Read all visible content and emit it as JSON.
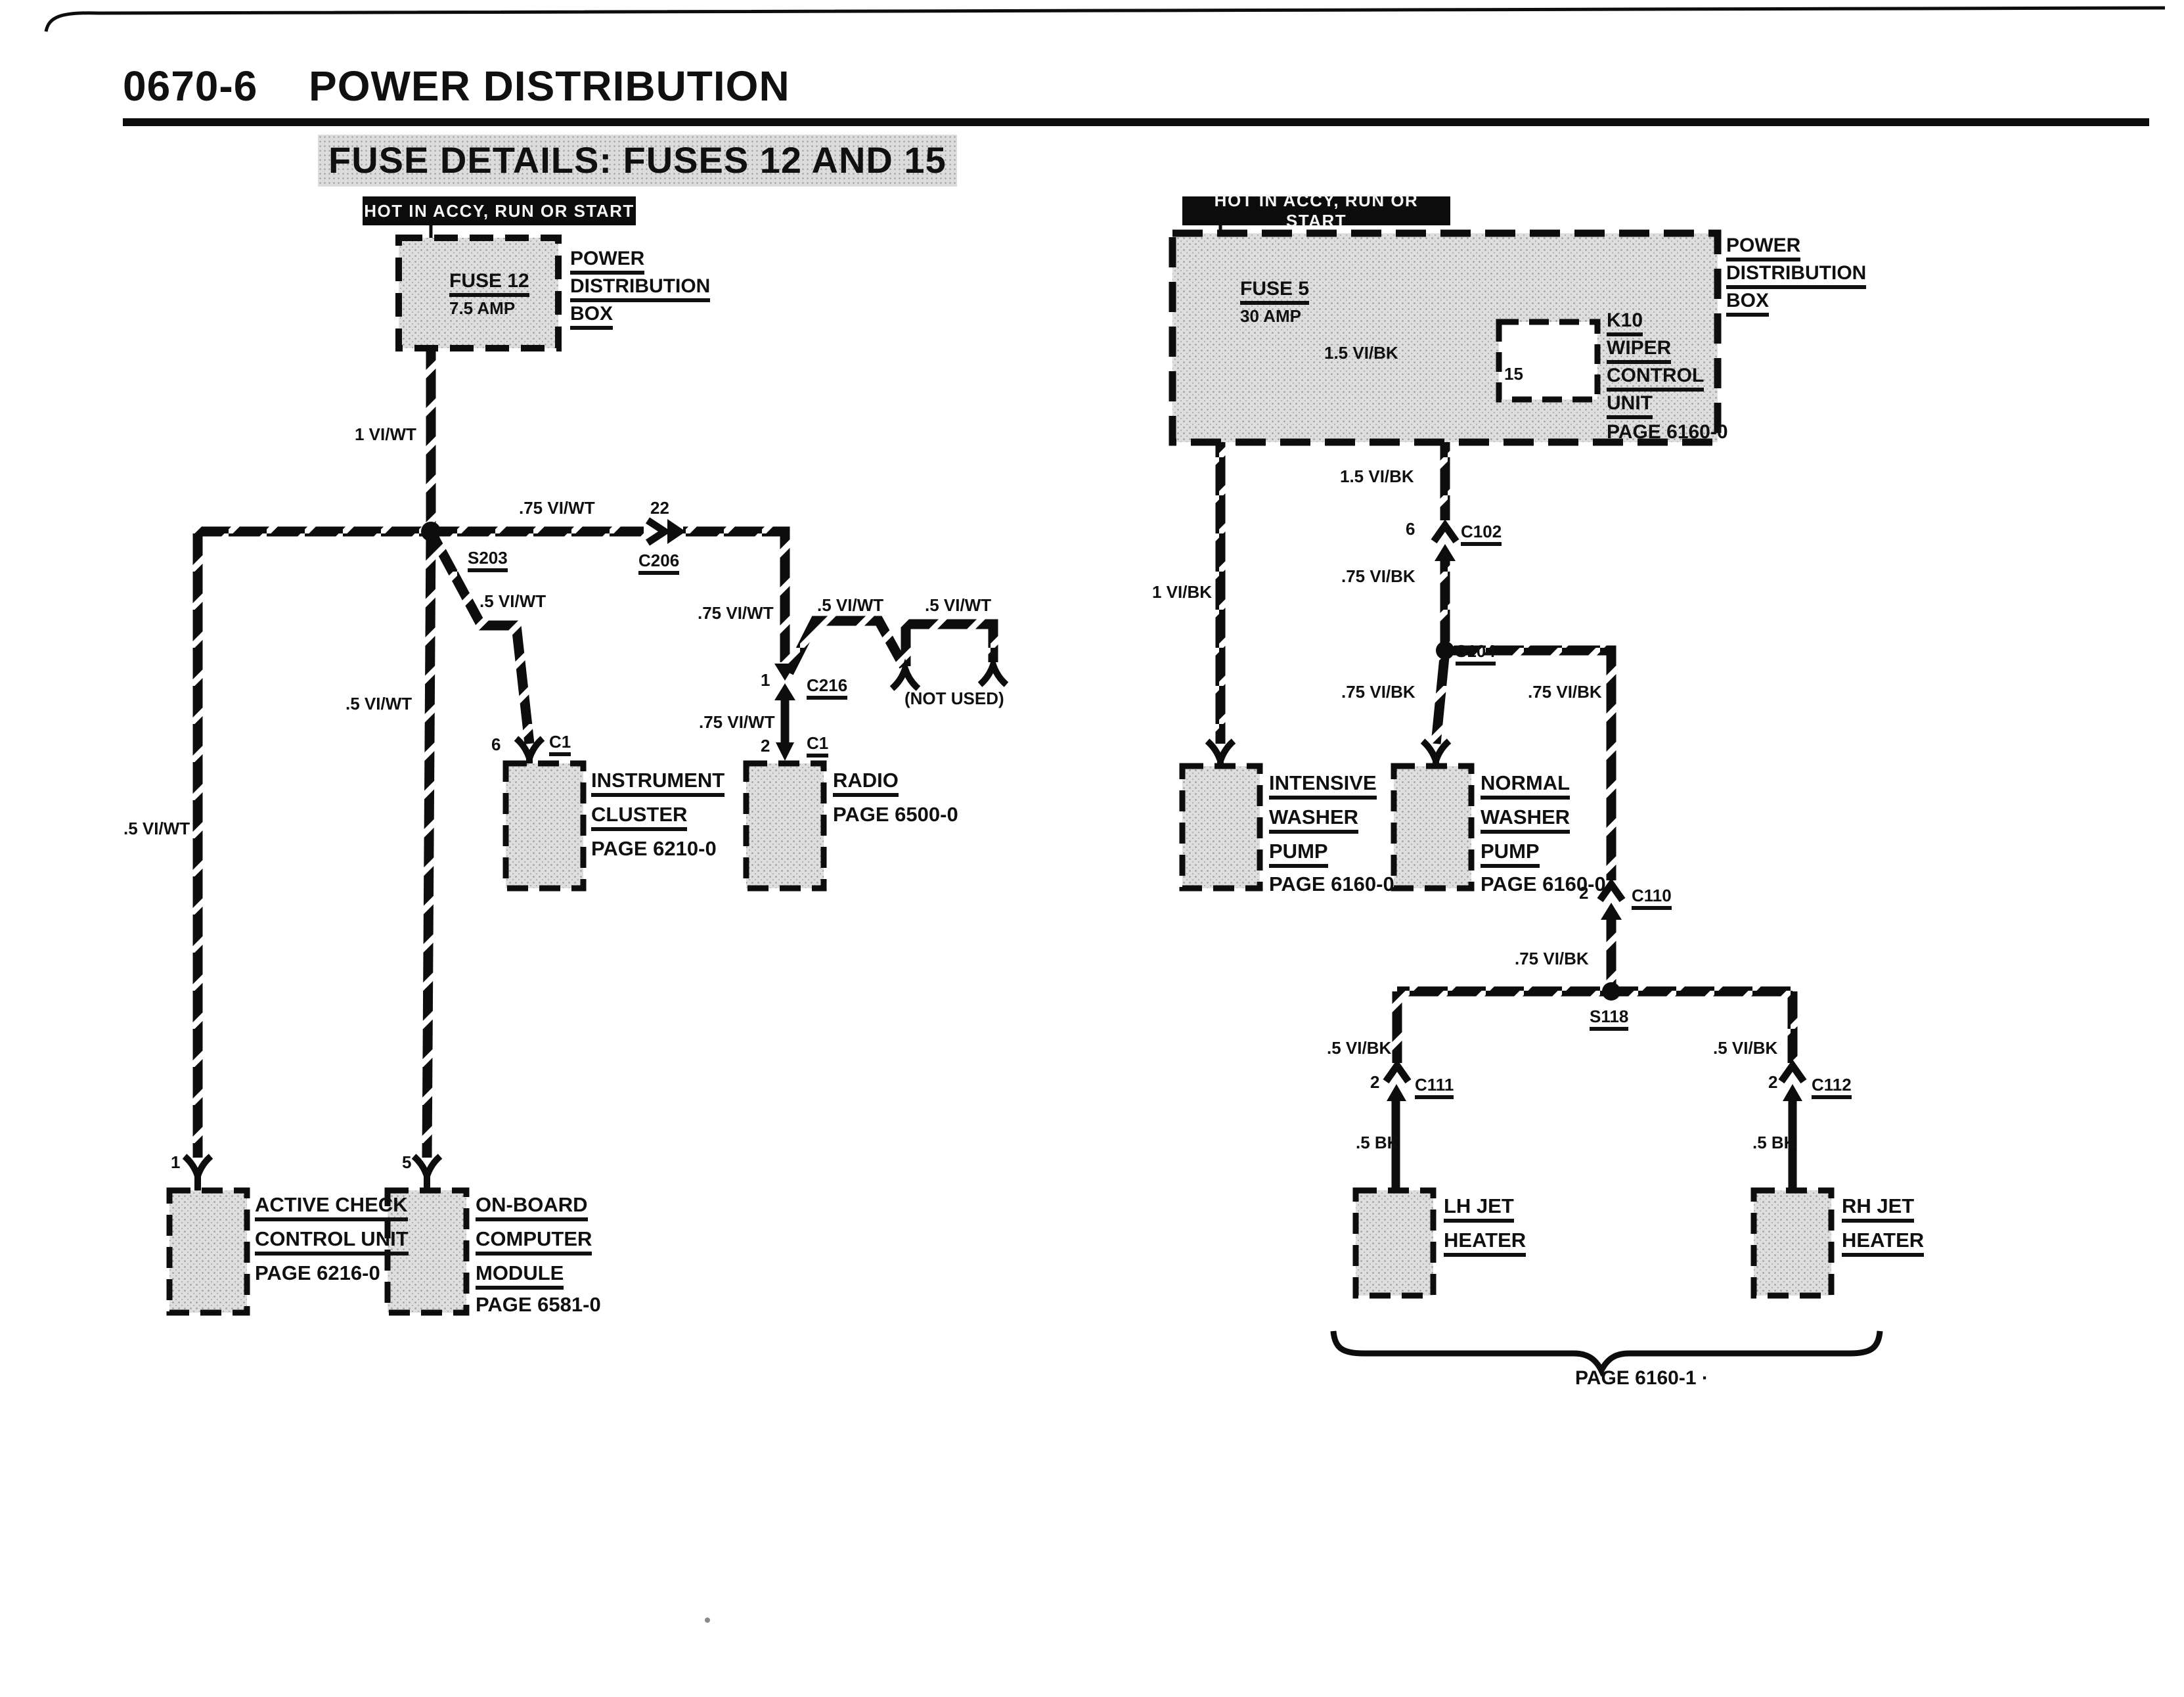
{
  "colors": {
    "ink": "#101010",
    "paper": "#ffffff",
    "shade": "#dcdcdc"
  },
  "page": {
    "doc_number": "0670-6",
    "title": "POWER DISTRIBUTION",
    "subtitle": "FUSE DETAILS: FUSES 12 AND 15"
  },
  "left": {
    "banner": "HOT IN ACCY, RUN OR START",
    "fuse_name": "FUSE 12",
    "fuse_rating": "7.5 AMP",
    "power_box": {
      "l1": "POWER",
      "l2": "DISTRIBUTION",
      "l3": "BOX"
    },
    "w_main": "1 VI/WT",
    "s203": "S203",
    "w_branch": ".75 VI/WT",
    "pin22": "22",
    "c206": "C206",
    "w_instr": ".5 VI/WT",
    "pin6": "6",
    "c1a": "C1",
    "instrument": {
      "l1": "INSTRUMENT",
      "l2": "CLUSTER",
      "page": "PAGE 6210-0"
    },
    "w_c216": ".75 VI/WT",
    "pin1_c216": "1",
    "c216": "C216",
    "w_nu1": ".5 VI/WT",
    "w_nu2": ".5 VI/WT",
    "not_used": "(NOT USED)",
    "w_radio": ".75 VI/WT",
    "pin2": "2",
    "c1b": "C1",
    "radio": {
      "l1": "RADIO",
      "page": "PAGE 6500-0"
    },
    "w_obc": ".5 VI/WT",
    "w_accu": ".5 VI/WT",
    "pin1_accu": "1",
    "active": {
      "l1": "ACTIVE CHECK",
      "l2": "CONTROL UNIT",
      "page": "PAGE 6216-0"
    },
    "pin5": "5",
    "obc": {
      "l1": "ON-BOARD",
      "l2": "COMPUTER",
      "l3": "MODULE",
      "page": "PAGE 6581-0"
    }
  },
  "right": {
    "banner": "HOT IN ACCY, RUN OR START",
    "power_box": {
      "l1": "POWER",
      "l2": "DISTRIBUTION",
      "l3": "BOX"
    },
    "fuse_name": "FUSE 5",
    "fuse_rating": "30 AMP",
    "w_k10": "1.5 VI/BK",
    "pin15": "15",
    "k10": {
      "l1": "K10",
      "l2": "WIPER",
      "l3": "CONTROL",
      "l4": "UNIT",
      "page": "PAGE 6160-0"
    },
    "w_down1": "1.5 VI/BK",
    "pin6": "6",
    "c102": "C102",
    "w_down2": ".75 VI/BK",
    "s104": "S104",
    "w_intensive": "1 VI/BK",
    "w_normal": ".75 VI/BK",
    "w_right": ".75 VI/BK",
    "intensive": {
      "l1": "INTENSIVE",
      "l2": "WASHER",
      "l3": "PUMP",
      "page": "PAGE 6160-0"
    },
    "normal": {
      "l1": "NORMAL",
      "l2": "WASHER",
      "l3": "PUMP",
      "page": "PAGE 6160-0"
    },
    "pin2_c110": "2",
    "c110": "C110",
    "w_s118": ".75 VI/BK",
    "s118": "S118",
    "w_lh1": ".5 VI/BK",
    "pin2_c111": "2",
    "c111": "C111",
    "w_lh2": ".5 BK",
    "lh": {
      "l1": "LH JET",
      "l2": "HEATER"
    },
    "w_rh1": ".5 VI/BK",
    "pin2_c112": "2",
    "c112": "C112",
    "w_rh2": ".5 BK",
    "rh": {
      "l1": "RH JET",
      "l2": "HEATER"
    },
    "page_ref": "PAGE 6160-1 ·"
  }
}
